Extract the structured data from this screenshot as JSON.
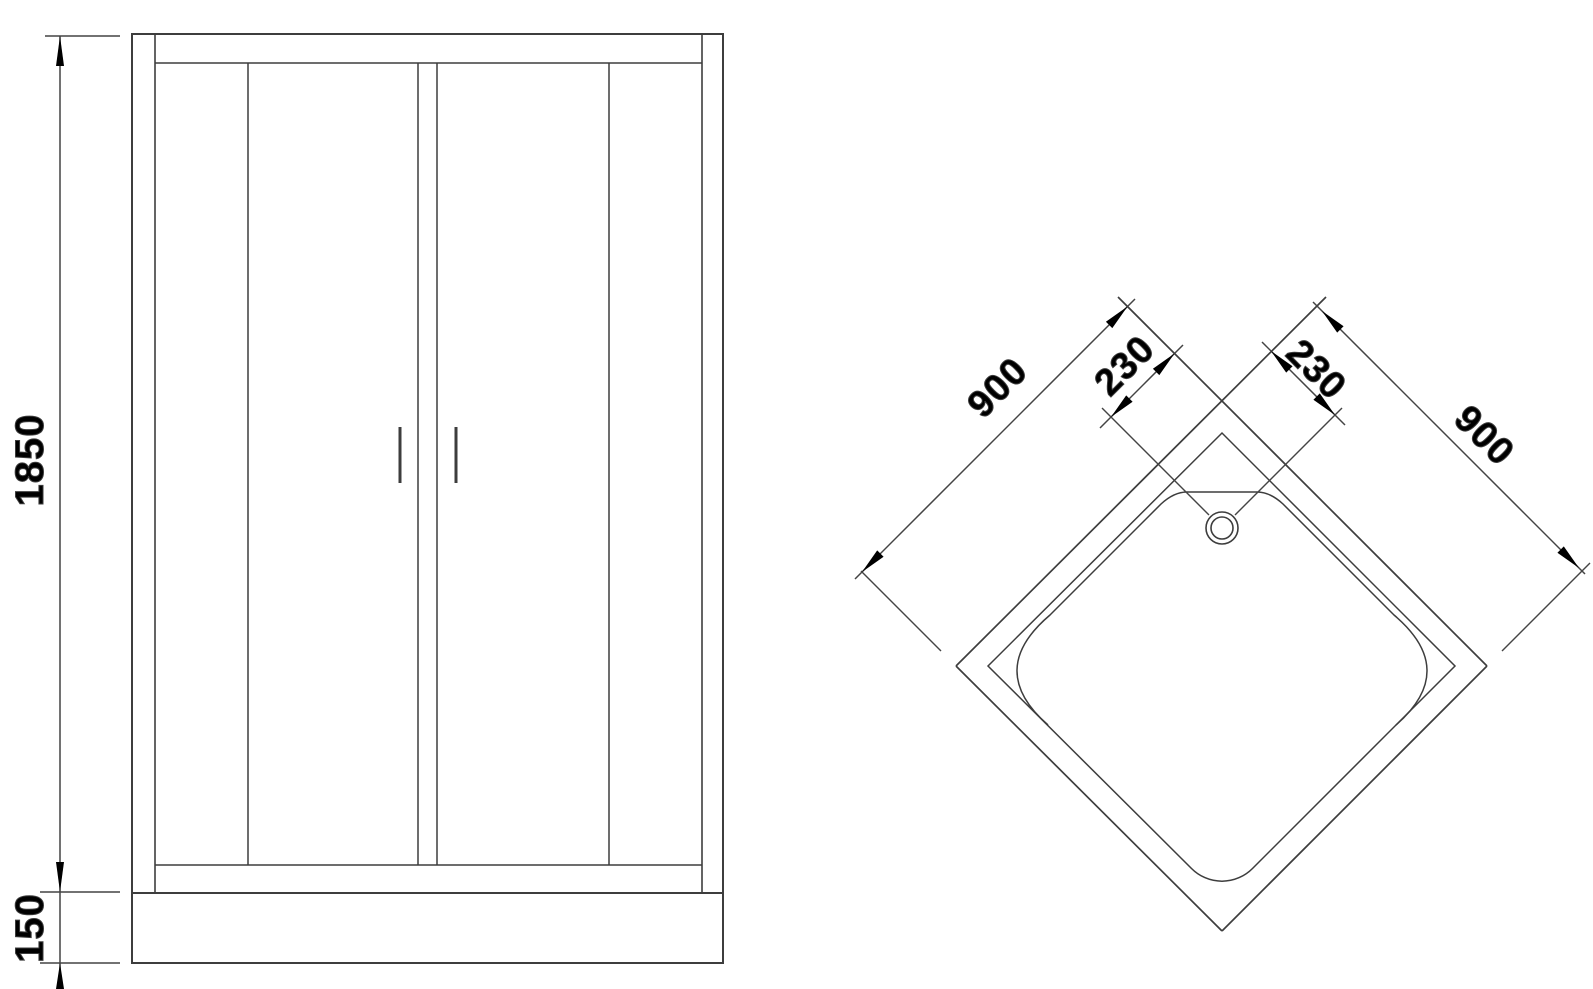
{
  "drawing": {
    "title": "shower-enclosure-technical-drawing",
    "line_color": "#3d3d3d",
    "dim_line_color": "#444444",
    "text_color": "#000000",
    "background": "#ffffff"
  },
  "front_view": {
    "name": "front elevation of shower enclosure",
    "height_label": "1850",
    "tray_height_label": "150"
  },
  "top_view": {
    "name": "top view of corner shower tray",
    "left_edge_label": "900",
    "right_edge_label": "900",
    "drain_offset_left_label": "230",
    "drain_offset_right_label": "230"
  }
}
